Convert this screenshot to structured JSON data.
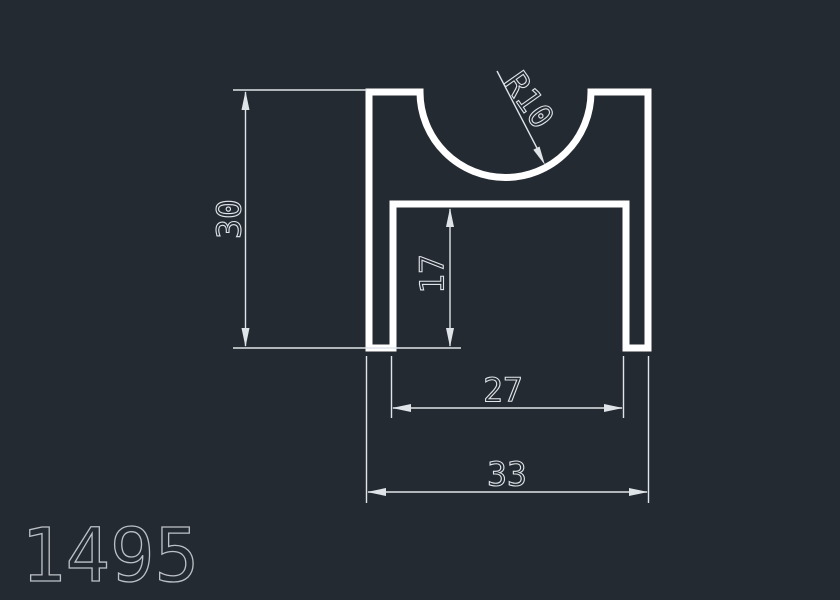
{
  "drawing": {
    "part_number": "1495",
    "dimension_labels": {
      "overall_height": "30",
      "channel_depth": "17",
      "channel_width": "27",
      "overall_width": "33",
      "groove_radius": "R10"
    },
    "colors": {
      "background": "#242A32",
      "profile_outline": "#ffffff",
      "dimension_lines": "#dfe4e8",
      "part_number_text": "#bcc1c7"
    }
  }
}
